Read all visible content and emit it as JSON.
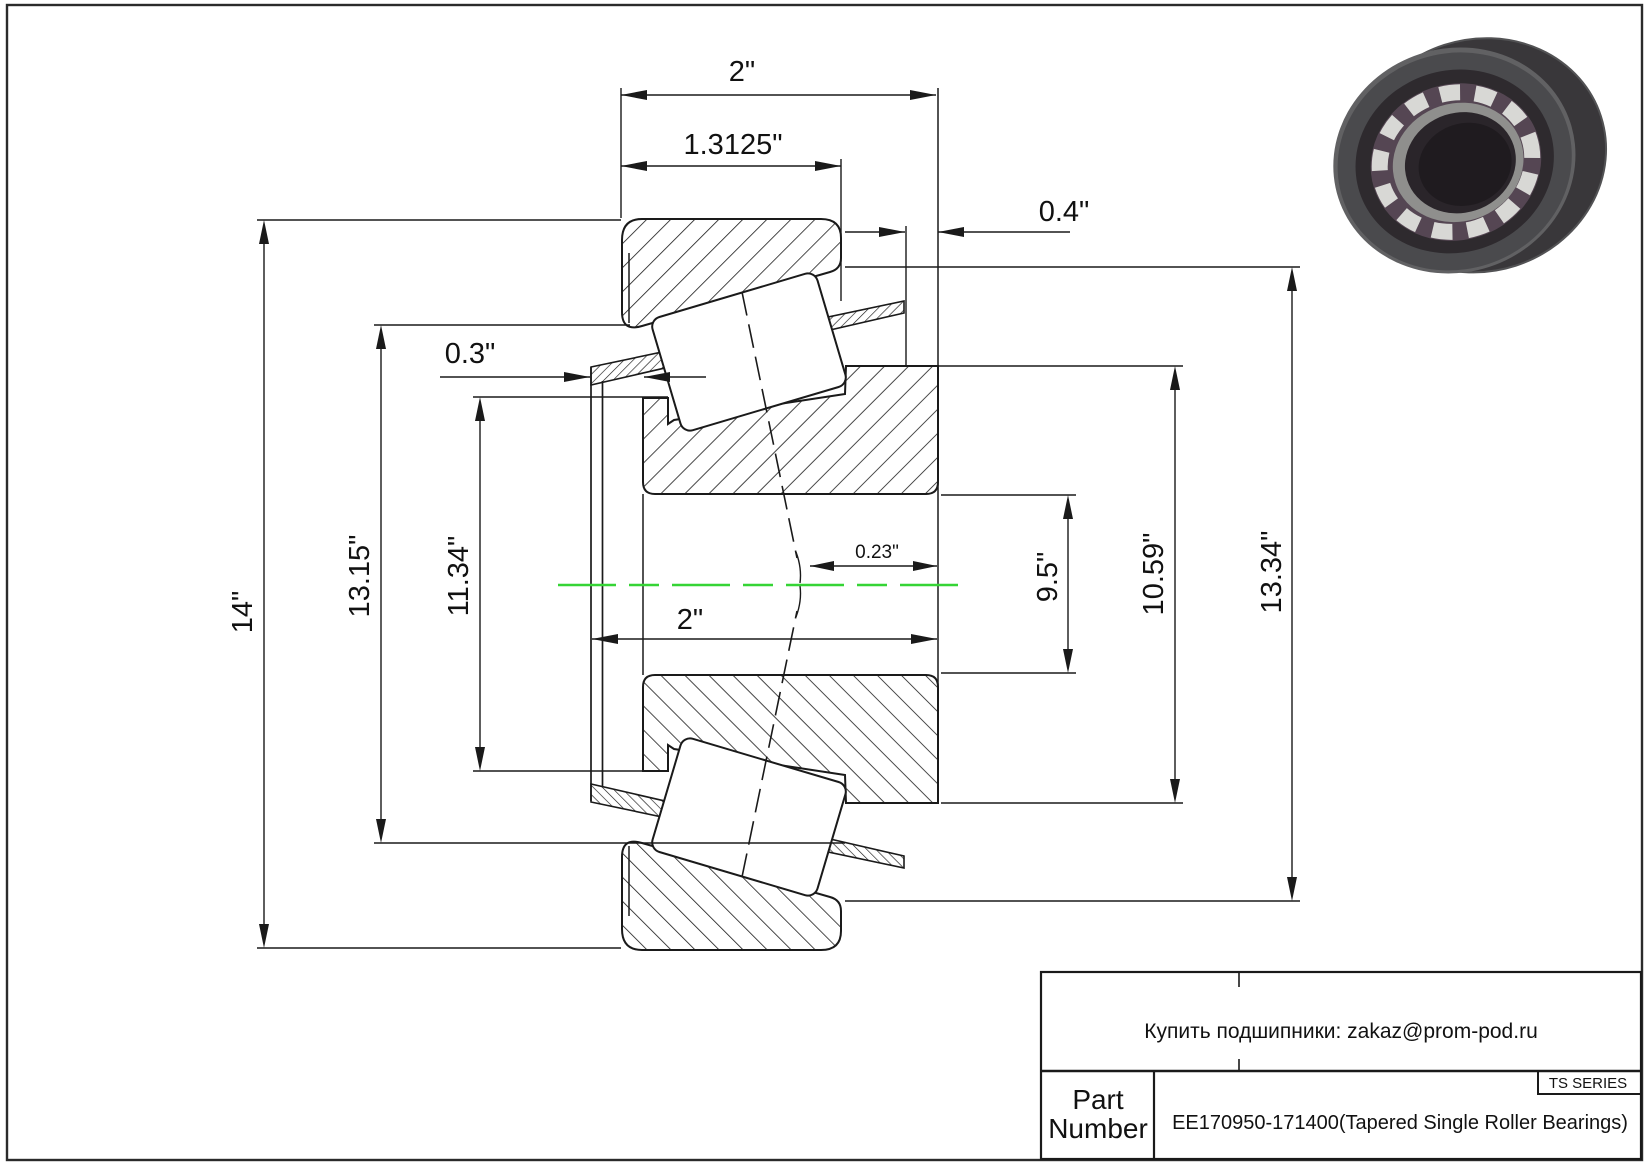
{
  "drawing": {
    "type": "tapered-roller-bearing-section",
    "dims": {
      "overall_width_top": "2\"",
      "cup_width": "1.3125\"",
      "back_cage_offset": "0.4\"",
      "front_cage_offset": "0.3\"",
      "outer_diameter": "14\"",
      "cup_inner_diameter": "13.15\"",
      "cone_front_rib_diameter": "11.34\"",
      "bore_diameter": "9.5\"",
      "cone_back_rib_diameter": "10.59\"",
      "cone_back_face_diameter": "13.34\"",
      "apex_offset": "0.23\"",
      "cone_width_bottom": "2\""
    },
    "colors": {
      "centerline_green": "#35d435",
      "line_black": "#1a1a1a"
    }
  },
  "title_block": {
    "supplier_note": "Купить подшипники: zakaz@prom-pod.ru",
    "series_label": "TS SERIES",
    "part_label_line1": "Part",
    "part_label_line2": "Number",
    "part_number": "EE170950-171400(Tapered Single Roller Bearings)"
  }
}
